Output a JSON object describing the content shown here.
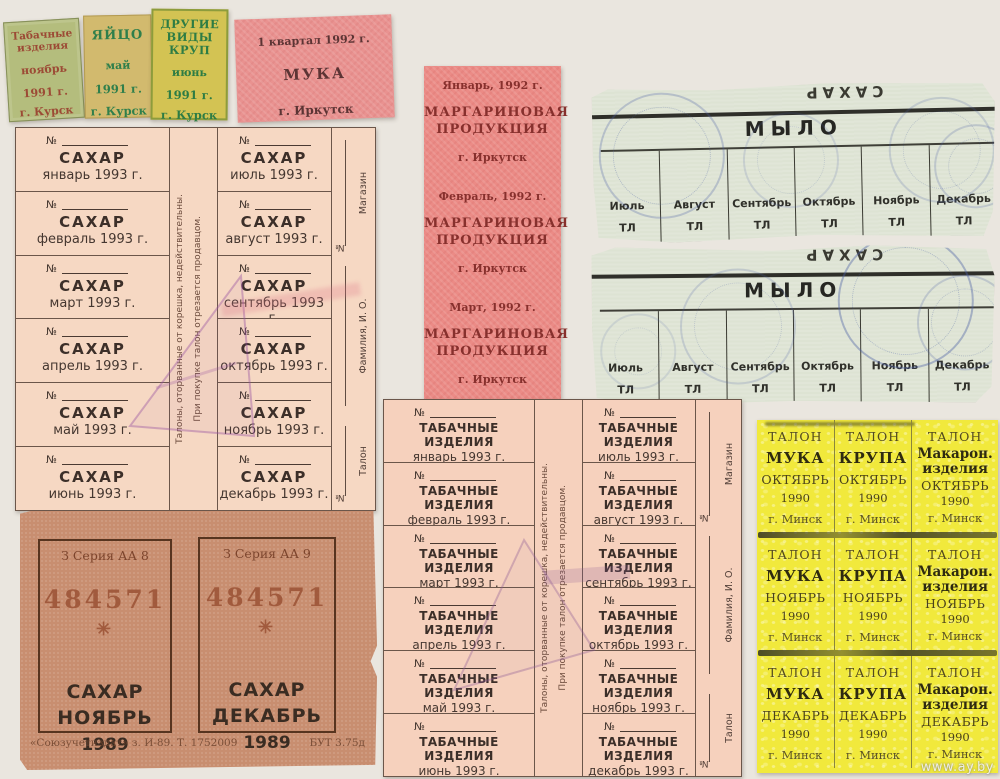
{
  "colors": {
    "page_bg": "#eae6df",
    "kursk_green_bg": "#b4bd7d",
    "kursk_tan_bg": "#d2ba6e",
    "kursk_yellow_bg": "#d3c353",
    "irkutsk_pink_bg": "#e99290",
    "irkutsk_red_bg": "#eb8b86",
    "sheet_pink_bg": "#f6d8c3",
    "soap_gray_green_bg": "#dde3d3",
    "sugar1989_brown_bg": "#c88e70",
    "minsk_yellow_bg": "#f1e93c",
    "stamp_blue": "#4b5fa5",
    "stamp_purple": "#9650a0"
  },
  "kursk": {
    "tobacco": {
      "line1": "Табачные",
      "line2": "изделия",
      "month": "ноябрь",
      "year": "1991 г.",
      "city": "г. Курск"
    },
    "egg": {
      "title": "ЯЙЦО",
      "month": "май",
      "year": "1991 г.",
      "city": "г. Курск"
    },
    "groats": {
      "line1": "ДРУГИЕ",
      "line2": "ВИДЫ",
      "line3": "КРУП",
      "month": "июнь",
      "year": "1991 г.",
      "city": "г. Курск"
    }
  },
  "irkutsk_flour": {
    "header": "1 квартал 1992 г.",
    "product": "МУКА",
    "city": "г. Иркутск"
  },
  "irkutsk_margarine": {
    "months": [
      "Январь, 1992 г.",
      "Февраль, 1992 г.",
      "Март, 1992 г."
    ],
    "product_line1": "МАРГАРИНОВАЯ",
    "product_line2": "ПРОДУКЦИЯ",
    "city": "г. Иркутск"
  },
  "sugar_sheet_1993": {
    "no_label": "№",
    "product": "САХАР",
    "months": [
      "январь 1993 г.",
      "февраль 1993 г.",
      "март 1993 г.",
      "апрель 1993 г.",
      "май 1993 г.",
      "июнь 1993 г.",
      "июль 1993 г.",
      "август 1993 г.",
      "сентябрь 1993 г.",
      "октябрь 1993 г.",
      "ноябрь 1993 г.",
      "декабрь 1993 г."
    ],
    "spine_line1": "Талоны, оторванные от корешка, недействительны.",
    "spine_line2": "При покупке талон отрезается продавцом.",
    "stub": {
      "shop": "Магазин",
      "no": "№",
      "name": "Фамилия, И. О.",
      "talon": "Талон"
    }
  },
  "tobacco_sheet_1993": {
    "no_label": "№",
    "product": "ТАБАЧНЫЕ ИЗДЕЛИЯ",
    "months": [
      "январь 1993 г.",
      "февраль 1993 г.",
      "март 1993 г.",
      "апрель 1993 г.",
      "май 1993 г.",
      "июнь 1993 г.",
      "июль 1993 г.",
      "август 1993 г.",
      "сентябрь 1993 г.",
      "октябрь 1993 г.",
      "ноябрь 1993 г.",
      "декабрь 1993 г."
    ],
    "spine_line1": "Талоны, оторванные от корешка, недействительны.",
    "spine_line2": "При покупке талон отрезается продавцом.",
    "stub": {
      "shop": "Магазин",
      "no": "№",
      "name": "Фамилия, И. О.",
      "talon": "Талон"
    }
  },
  "soap_coupons": {
    "inverted_top": "САХАР",
    "title": "МЫЛО",
    "months": [
      "Июль",
      "Август",
      "Сентябрь",
      "Октябрь",
      "Ноябрь",
      "Декабрь"
    ],
    "unit": "ТЛ"
  },
  "sugar_1989": {
    "left": {
      "series": "З Серия АА 8",
      "number": "484571",
      "star": "✳",
      "product": "САХАР",
      "month": "НОЯБРЬ",
      "year": "1989"
    },
    "right": {
      "series": "З Серия АА 9",
      "number": "484571",
      "star": "✳",
      "product": "САХАР",
      "month": "ДЕКАБРЬ",
      "year": "1989"
    },
    "footer_left": "«Союзучетиздат» з. И-89. Т. 1752009",
    "footer_right": "БУТ 3.75д"
  },
  "minsk_1990": {
    "talon_label": "ТАЛОН",
    "products": [
      "МУКА",
      "КРУПА"
    ],
    "product3_line1": "Макарон.",
    "product3_line2": "изделия",
    "months": [
      "ОКТЯБРЬ",
      "НОЯБРЬ",
      "ДЕКАБРЬ"
    ],
    "year": "1990",
    "city": "г. Минск"
  },
  "watermark": "www.ay.by"
}
